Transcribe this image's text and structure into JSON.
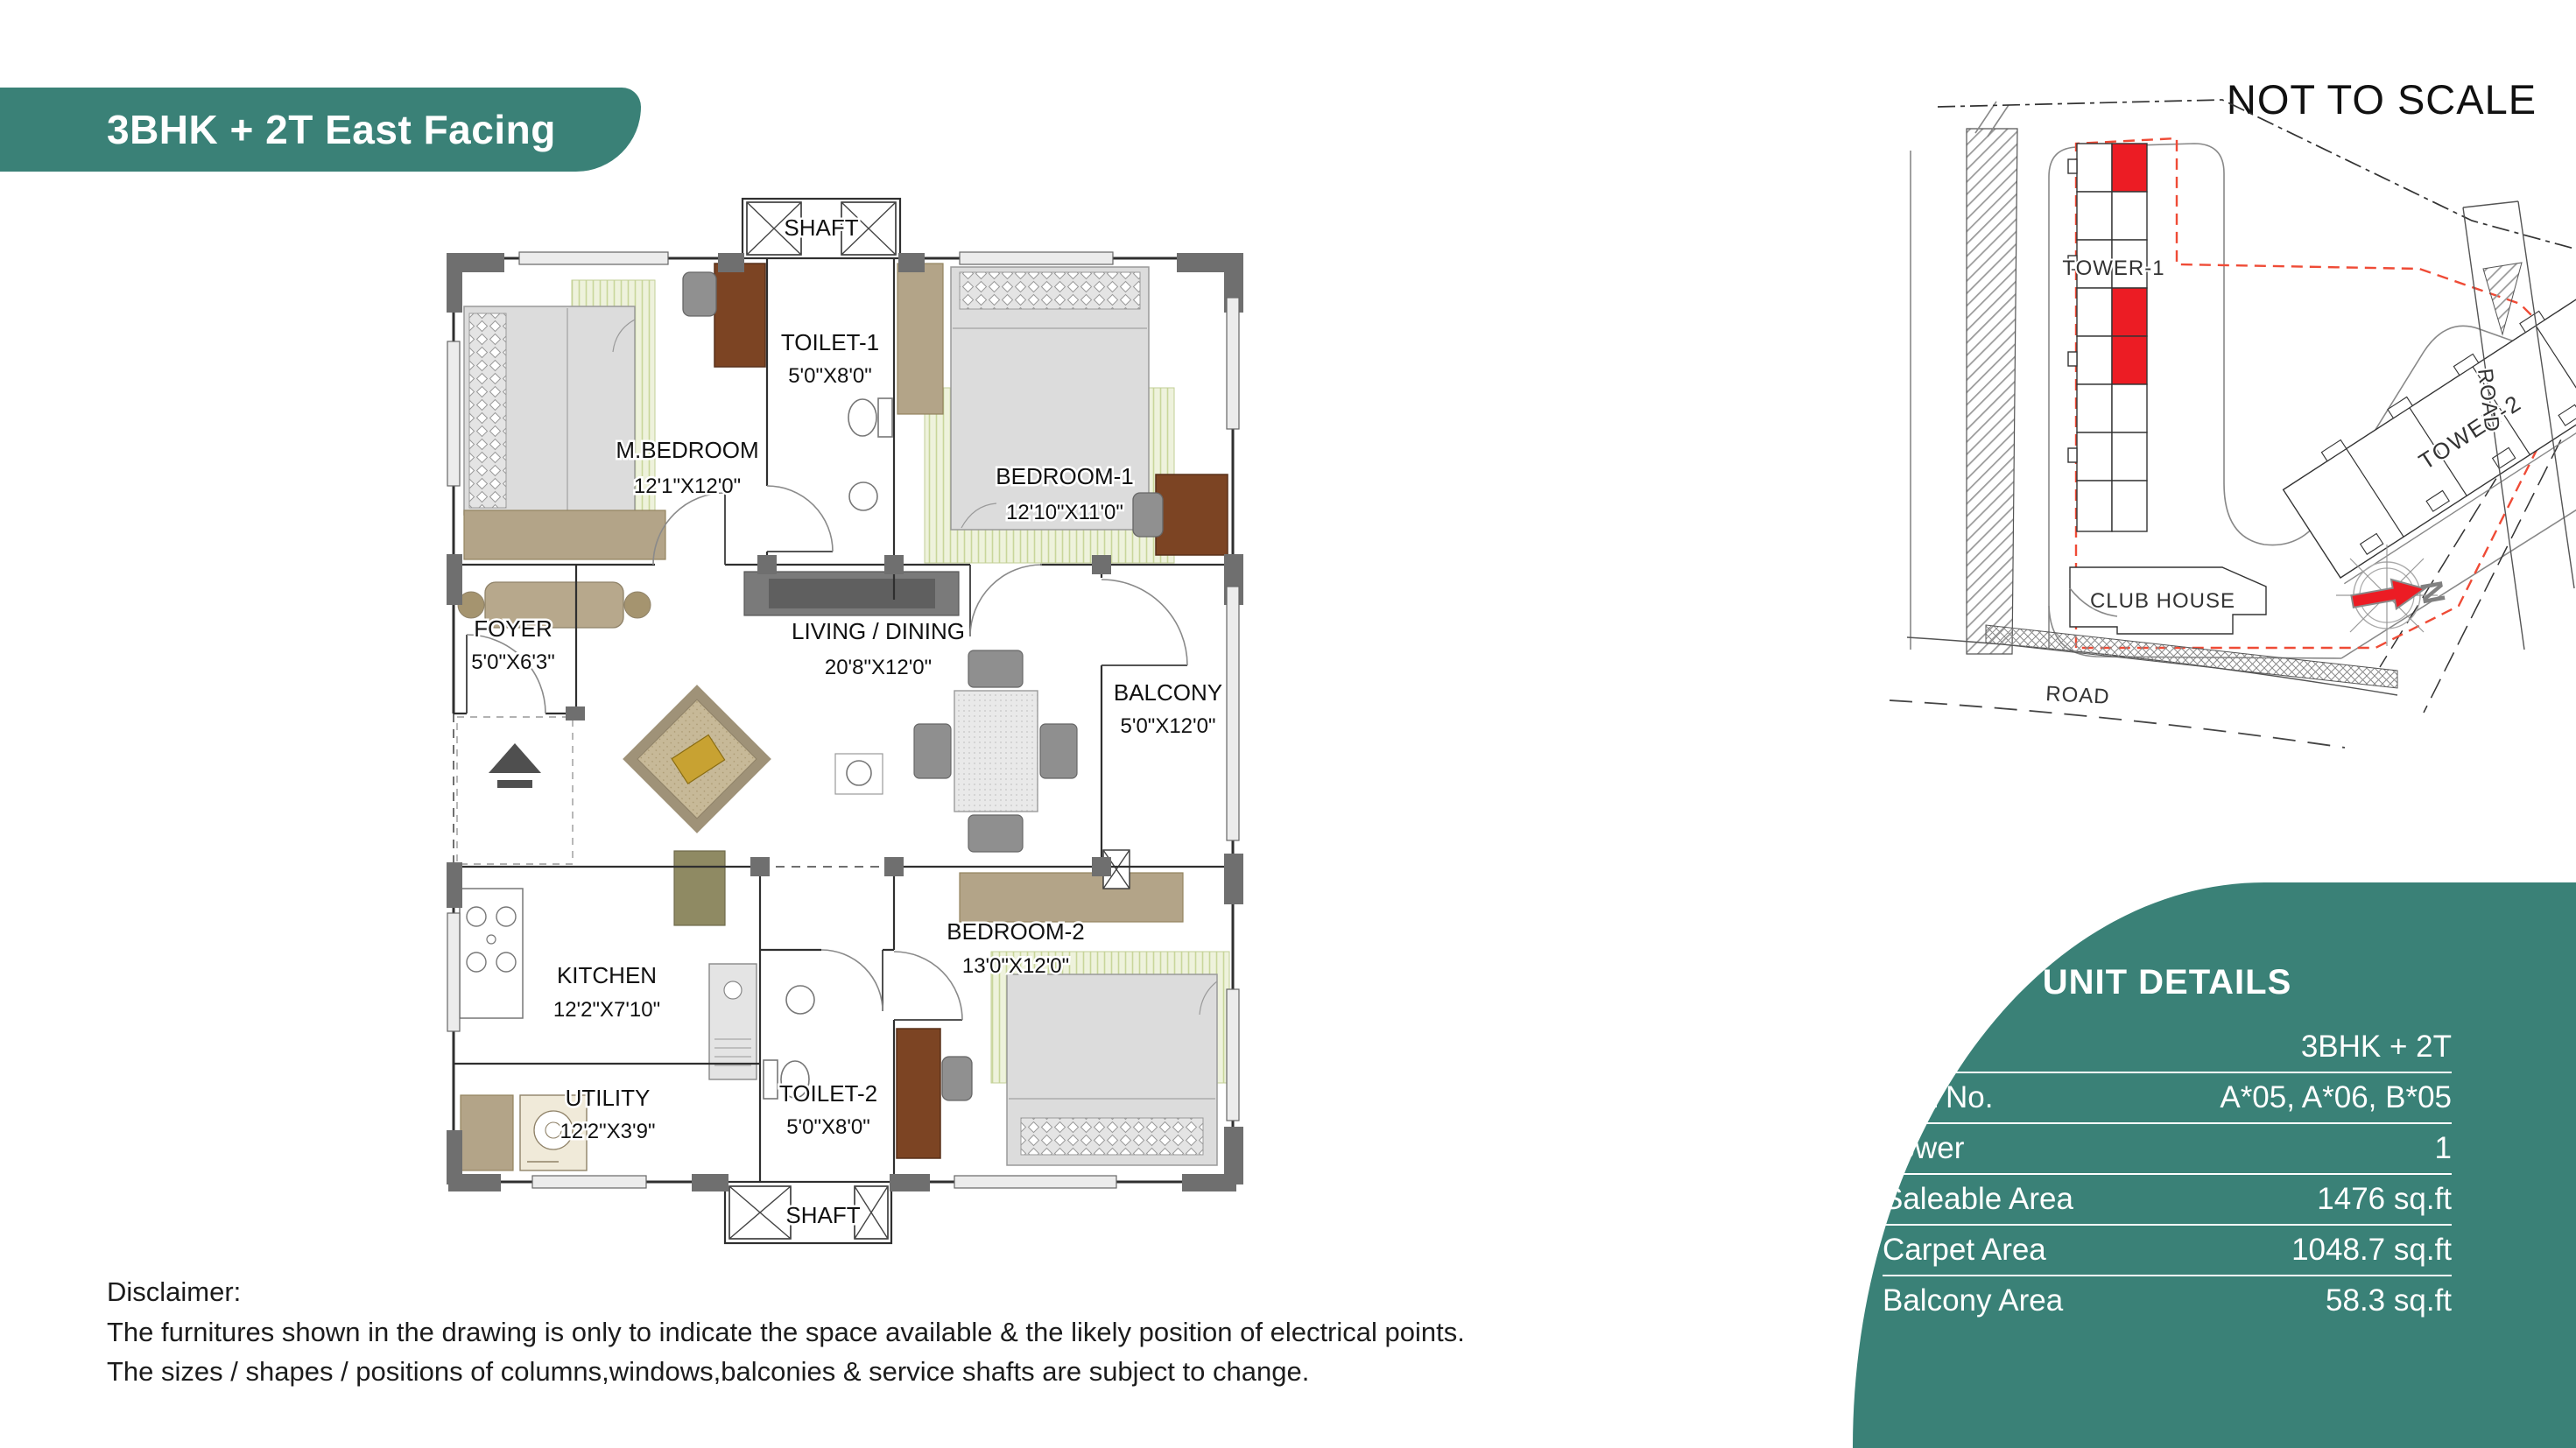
{
  "banner": {
    "title": "3BHK + 2T East Facing"
  },
  "site_map": {
    "scale_note": "NOT TO SCALE",
    "tower1_label": "TOWER-1",
    "tower2_label": "TOWER-2",
    "club_house_label": "CLUB HOUSE",
    "road_bottom_label": "ROAD",
    "road_right_label": "ROAD",
    "compass_north_label": "N"
  },
  "floor_plan": {
    "shaft_top": {
      "name": "SHAFT"
    },
    "shaft_bottom": {
      "name": "SHAFT"
    },
    "rooms": {
      "m_bedroom": {
        "name": "M.BEDROOM",
        "dims": "12'1\"X12'0\""
      },
      "toilet1": {
        "name": "TOILET-1",
        "dims": "5'0\"X8'0\""
      },
      "bedroom1": {
        "name": "BEDROOM-1",
        "dims": "12'10\"X11'0\""
      },
      "foyer": {
        "name": "FOYER",
        "dims": "5'0\"X6'3\""
      },
      "living": {
        "name": "LIVING / DINING",
        "dims": "20'8\"X12'0\""
      },
      "balcony": {
        "name": "BALCONY",
        "dims": "5'0\"X12'0\""
      },
      "kitchen": {
        "name": "KITCHEN",
        "dims": "12'2\"X7'10\""
      },
      "utility": {
        "name": "UTILITY",
        "dims": "12'2\"X3'9\""
      },
      "toilet2": {
        "name": "TOILET-2",
        "dims": "5'0\"X8'0\""
      },
      "bedroom2": {
        "name": "BEDROOM-2",
        "dims": "13'0\"X12'0\""
      }
    }
  },
  "unit_details": {
    "heading": "UNIT DETAILS",
    "rows": [
      {
        "label": "Type",
        "value": "3BHK + 2T"
      },
      {
        "label": "Unit No.",
        "value": "A*05, A*06, B*05"
      },
      {
        "label": "Tower",
        "value": "1"
      },
      {
        "label": "Saleable Area",
        "value": "1476 sq.ft"
      },
      {
        "label": "Carpet Area",
        "value": "1048.7 sq.ft"
      },
      {
        "label": "Balcony Area",
        "value": "58.3 sq.ft"
      }
    ]
  },
  "disclaimer": {
    "title": "Disclaimer:",
    "lines": [
      "The furnitures shown in the drawing is only to indicate the space available & the likely position of electrical points.",
      "The sizes / shapes / positions of columns,windows,balconies & service shafts are subject to change."
    ]
  },
  "colors": {
    "brand_teal": "#3A8177",
    "highlight_red": "#EC1C24",
    "boundary_red": "#EF4B36"
  }
}
